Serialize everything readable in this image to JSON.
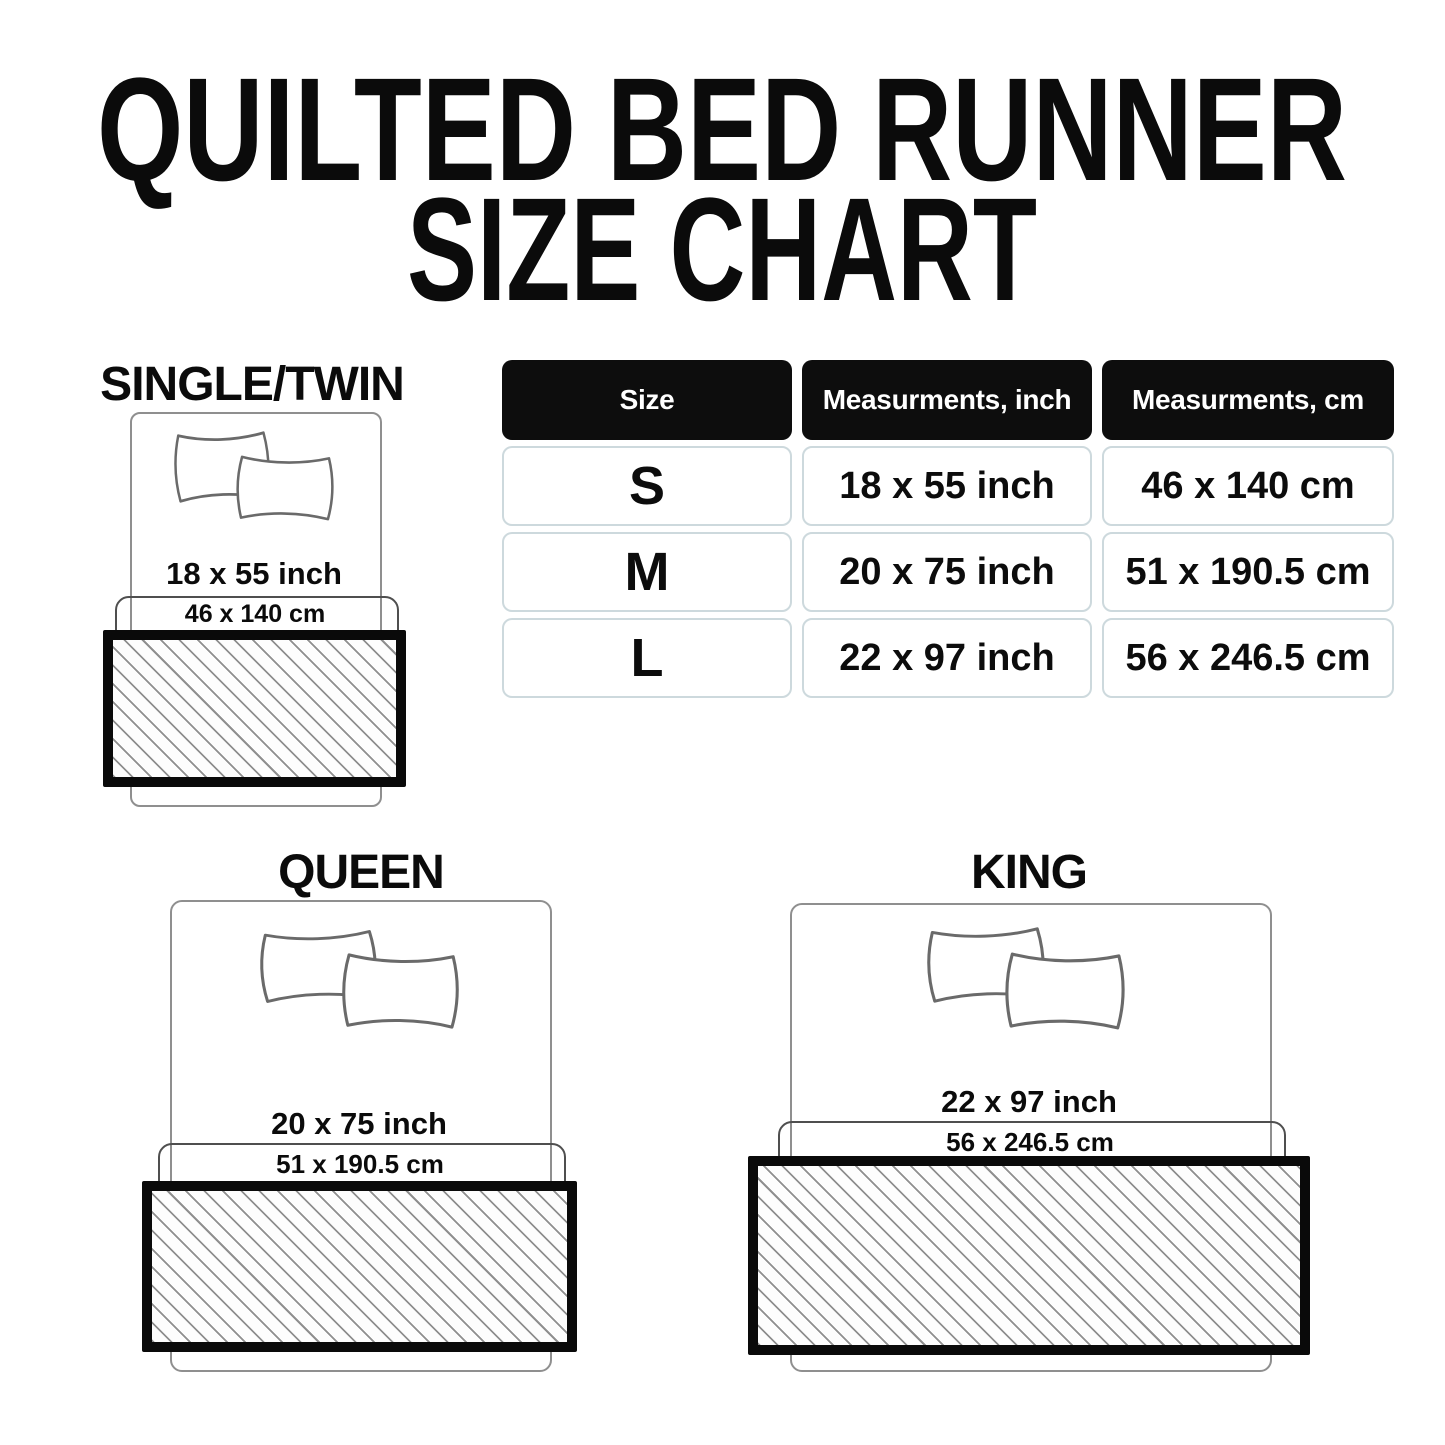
{
  "title": {
    "line1": "QUILTED BED RUNNER",
    "line2": "SIZE CHART"
  },
  "table": {
    "headers": {
      "size": "Size",
      "inch": "Measurments, inch",
      "cm": "Measurments, cm"
    },
    "rows": [
      {
        "size": "S",
        "inch": "18 x 55 inch",
        "cm": "46 x 140 cm"
      },
      {
        "size": "M",
        "inch": "20 x 75 inch",
        "cm": "51 x 190.5 cm"
      },
      {
        "size": "L",
        "inch": "22 x 97 inch",
        "cm": "56 x 246.5 cm"
      }
    ]
  },
  "diagrams": {
    "single": {
      "label": "SINGLE/TWIN",
      "inch": "18 x 55 inch",
      "cm": "46 x 140 cm"
    },
    "queen": {
      "label": "QUEEN",
      "inch": "20 x 75 inch",
      "cm": "51 x 190.5 cm"
    },
    "king": {
      "label": "KING",
      "inch": "22 x 97 inch",
      "cm": "56 x 246.5 cm"
    }
  },
  "colors": {
    "background": "#ffffff",
    "text": "#0b0b0b",
    "table_header_bg": "#0d0d0d",
    "table_header_text": "#ffffff",
    "table_cell_border": "#cdd9dd",
    "bed_outline": "#8f8f8f",
    "cm_rect_outline": "#4f4f4f",
    "runner_border": "#0a0a0a",
    "hatch_line": "#8f8f8f"
  }
}
